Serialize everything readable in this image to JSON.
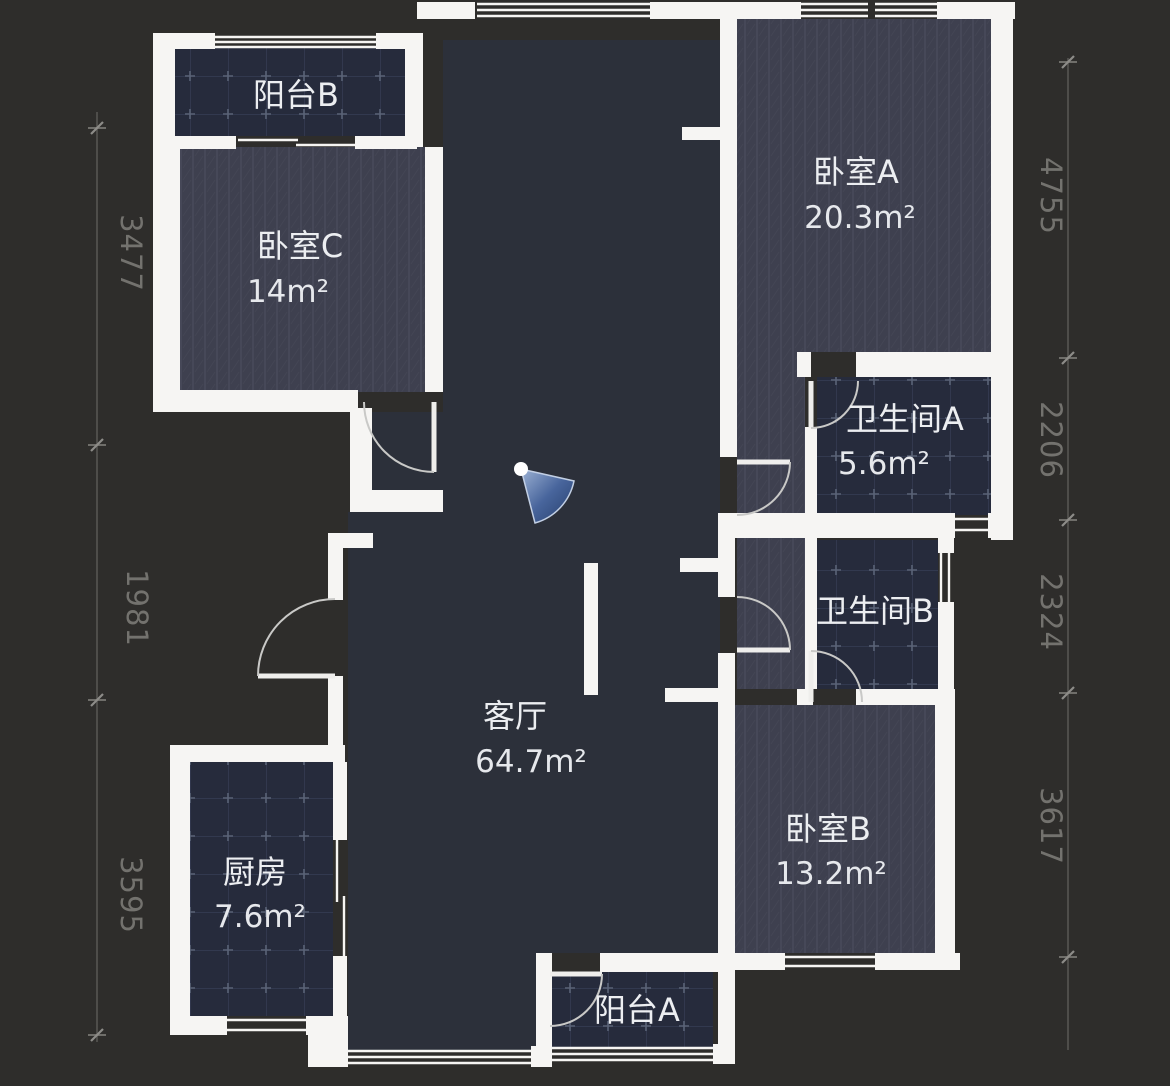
{
  "floorplan": {
    "rooms": {
      "balcony_b": {
        "label": "阳台B",
        "area": ""
      },
      "bedroom_c": {
        "label": "卧室C",
        "area": "14m²"
      },
      "bedroom_a": {
        "label": "卧室A",
        "area": "20.3m²"
      },
      "bathroom_a": {
        "label": "卫生间A",
        "area": "5.6m²"
      },
      "bathroom_b": {
        "label": "卫生间B",
        "area": ""
      },
      "living_room": {
        "label": "客厅",
        "area": "64.7m²"
      },
      "kitchen": {
        "label": "厨房",
        "area": "7.6m²"
      },
      "bedroom_b": {
        "label": "卧室B",
        "area": "13.2m²"
      },
      "balcony_a": {
        "label": "阳台A",
        "area": ""
      }
    },
    "dimensions": {
      "left": [
        "3477",
        "1981",
        "3595"
      ],
      "right": [
        "4755",
        "2206",
        "2324",
        "3617"
      ]
    },
    "colors": {
      "wall": "#f6f5f3",
      "living_floor": "#2c303a",
      "outside": "#2e2d2b",
      "wood_floor": "#3e404f",
      "tile_floor": "#262b3c",
      "fan_accent": "#2a4472",
      "dimension_text": "#73726e"
    }
  }
}
